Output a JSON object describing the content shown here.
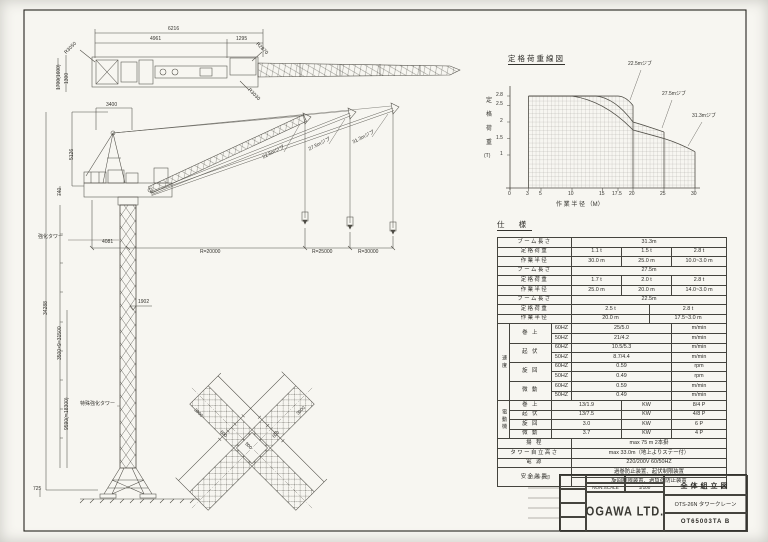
{
  "sheet": {
    "note": "※リンク印"
  },
  "plan_view": {
    "dims": {
      "overall": "6216",
      "left": "4961",
      "right": "1295",
      "r1": "R3050",
      "r2": "R2870",
      "r3": "R3030",
      "side1": "1300",
      "side2": "1700(1600)"
    }
  },
  "elevation": {
    "dims": {
      "top": "3400",
      "apex": "5126",
      "deck": "740",
      "overall": "34288",
      "upper": "3500×9=31500",
      "lower": "9590(≒18300)",
      "base": "725",
      "level": "1902",
      "front": "4081",
      "r20": "R=20000",
      "r25": "R=25000",
      "r30": "R=30000"
    },
    "labels": {
      "tower1": "強化タワー",
      "tower2": "特殊強化タワー"
    }
  },
  "base_plan": {
    "dims": [
      "3000",
      "600",
      "500",
      "600",
      "3000"
    ]
  },
  "chart_data": {
    "type": "line",
    "title": "定格荷重線図",
    "xlabel": "作 業 半 径 （M）",
    "ylabel": "定格荷重（T）",
    "ylabel_chars": [
      "定",
      "格",
      "荷",
      "重",
      "(T)"
    ],
    "xlim": [
      0,
      30
    ],
    "ylim": [
      0,
      2.8
    ],
    "x_ticks": [
      0,
      3,
      5,
      10,
      15,
      17.5,
      20,
      25,
      30
    ],
    "x_tick_labels": [
      "0",
      "3",
      "5",
      "10",
      "15",
      "17.5",
      "20",
      "25",
      "30"
    ],
    "y_ticks": [
      1,
      1.5,
      2,
      2.5,
      2.8
    ],
    "y_tick_labels": [
      "2.8",
      "2.5",
      "2",
      "1.5",
      "1"
    ],
    "grid": true,
    "legend_position": "right-annotations",
    "series": [
      {
        "name": "22.5mジブ",
        "x": [
          3,
          17.5,
          20
        ],
        "y": [
          2.8,
          2.8,
          2.5
        ]
      },
      {
        "name": "27.5mジブ",
        "x": [
          3,
          14,
          20,
          25
        ],
        "y": [
          2.8,
          2.8,
          2.0,
          1.7
        ]
      },
      {
        "name": "31.3mジブ",
        "x": [
          3,
          10,
          20,
          25,
          30
        ],
        "y": [
          2.8,
          2.8,
          1.75,
          1.5,
          1.1
        ]
      }
    ]
  },
  "spec": {
    "title": "仕  様",
    "boom_label": "ブーム長さ",
    "load_label": "定格荷重",
    "radius_label": "作業半径",
    "booms": [
      {
        "len": "31.3m",
        "loads": [
          "1.1 t",
          "1.5 t",
          "2.8 t"
        ],
        "radii": [
          "30.0 m",
          "25.0 m",
          "10.0~3.0 m"
        ]
      },
      {
        "len": "27.5m",
        "loads": [
          "1.7 t",
          "2.0 t",
          "2.8 t"
        ],
        "radii": [
          "25.0 m",
          "20.0 m",
          "14.0~3.0 m"
        ]
      },
      {
        "len": "22.5m",
        "loads": [
          "2.5 t",
          "2.8 t"
        ],
        "radii": [
          "20.0 m",
          "17.5~3.0 m"
        ]
      }
    ],
    "speed": {
      "group": "速度",
      "items": [
        {
          "name": "巻 上",
          "r": [
            {
              "hz": "60HZ",
              "val": "25/5.0",
              "unit": "m/min"
            },
            {
              "hz": "50HZ",
              "val": "21/4.2",
              "unit": "m/min"
            }
          ]
        },
        {
          "name": "起 伏",
          "r": [
            {
              "hz": "60HZ",
              "val": "10.5/5.3",
              "unit": "m/min"
            },
            {
              "hz": "50HZ",
              "val": "8.7/4.4",
              "unit": "m/min"
            }
          ]
        },
        {
          "name": "旋 回",
          "r": [
            {
              "hz": "60HZ",
              "val": "0.59",
              "unit": "rpm"
            },
            {
              "hz": "50HZ",
              "val": "0.49",
              "unit": "rpm"
            }
          ]
        },
        {
          "name": "微 動",
          "r": [
            {
              "hz": "60HZ",
              "val": "0.59",
              "unit": "m/min"
            },
            {
              "hz": "50HZ",
              "val": "0.49",
              "unit": "m/min"
            }
          ]
        }
      ]
    },
    "motor": {
      "group": "電動機",
      "items": [
        {
          "name": "巻 上",
          "val": "13/1.9",
          "unit": "KW",
          "pole": "8/4 P"
        },
        {
          "name": "起 伏",
          "val": "13/7.5",
          "unit": "KW",
          "pole": "4/8 P"
        },
        {
          "name": "旋 回",
          "val": "3.0",
          "unit": "KW",
          "pole": "6 P"
        },
        {
          "name": "微 動",
          "val": "3.7",
          "unit": "KW",
          "pole": "4 P"
        }
      ]
    },
    "extras": [
      {
        "label": "揚  程",
        "value": "max 75 m  2本掛"
      },
      {
        "label": "タワー自立高さ",
        "value": "max 33.0m（地上よりステー付）"
      },
      {
        "label": "電  源",
        "value": "220/200V  60/50HZ"
      }
    ],
    "safety": {
      "label": "安全装置",
      "line1": "過巻防止装置、起伏制限装置",
      "line2": "旋回制限装置、過負荷防止装置"
    }
  },
  "title_block": {
    "company": "OGAWA LTD.",
    "scale_label": "NON.SCALE",
    "scale": "1/100",
    "drawing_title": "全体組立図",
    "model": "OTS-26N タワークレーン",
    "number": "OT65003TA B"
  }
}
